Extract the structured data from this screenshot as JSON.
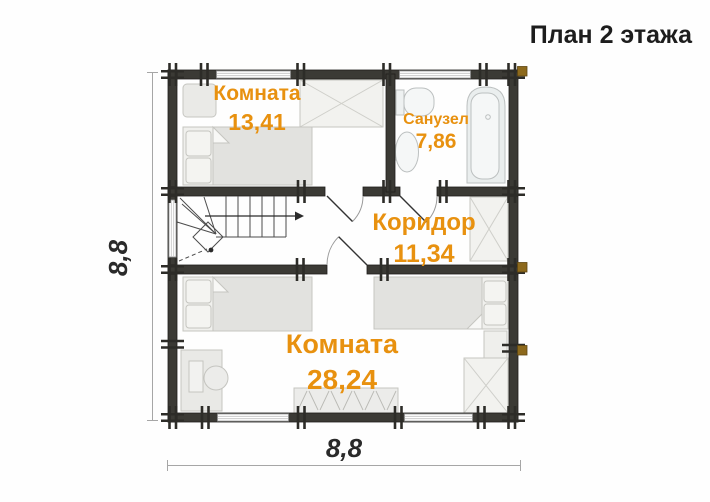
{
  "title": "План 2 этажа",
  "rooms": {
    "room_top": {
      "name": "Комната",
      "area": "13,41"
    },
    "bathroom": {
      "name": "Санузел",
      "area": "7,86"
    },
    "corridor": {
      "name": "Коридор",
      "area": "11,34"
    },
    "room_bottom": {
      "name": "Комната",
      "area": "28,24"
    }
  },
  "dimensions": {
    "width": "8,8",
    "height": "8,8"
  },
  "colors": {
    "wall": "#3b3a35",
    "room_label": "#e8910f",
    "log_accent": "#8d691c"
  }
}
